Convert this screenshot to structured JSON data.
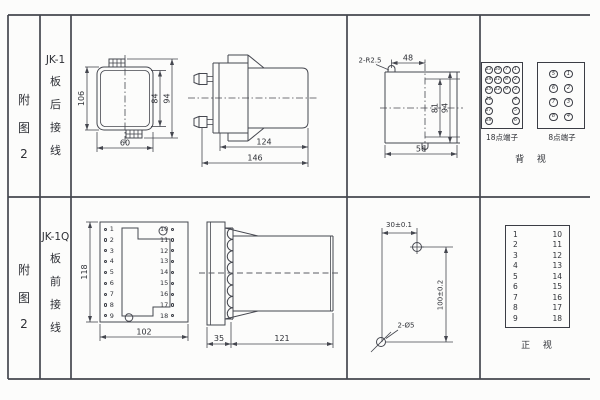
{
  "colors": {
    "line": "#45474f",
    "text": "#2e3036",
    "background": "#fcfcfb"
  },
  "header": {
    "row1": {
      "fig": [
        "附",
        "图",
        "2"
      ],
      "model": "JK-1",
      "wiring": [
        "板",
        "后",
        "接",
        "线"
      ]
    },
    "row2": {
      "fig": [
        "附",
        "图",
        "2"
      ],
      "model": "JK-1Q",
      "wiring": [
        "板",
        "前",
        "接",
        "线"
      ]
    }
  },
  "jk1": {
    "rear": {
      "height": "106",
      "inner": "84",
      "outer": "94",
      "width": "60"
    },
    "side": {
      "body": "124",
      "total": "146"
    },
    "cutout": {
      "radius": "2-R2.5",
      "top": "48",
      "inner": "81",
      "outer": "94",
      "bottom": "56"
    },
    "back_terms": {
      "t18": {
        "label": "18点端子",
        "cells": [
          "13",
          "10",
          "7",
          "1",
          "14",
          "11",
          "8",
          "2",
          "15",
          "12",
          "9",
          "3",
          "16",
          "",
          "",
          "4",
          "17",
          "",
          "",
          "5",
          "18",
          "",
          "",
          "6"
        ]
      },
      "t8": {
        "label": "8点端子",
        "cells": [
          "5",
          "1",
          "6",
          "2",
          "7",
          "3",
          "8",
          "4"
        ]
      },
      "view": "背 视"
    }
  },
  "jk1q": {
    "front": {
      "height": "118",
      "width": "102",
      "left": [
        "1",
        "2",
        "3",
        "4",
        "5",
        "6",
        "7",
        "8",
        "9"
      ],
      "right": [
        "10",
        "11",
        "12",
        "13",
        "14",
        "15",
        "16",
        "17",
        "18"
      ]
    },
    "side": {
      "front": "35",
      "body": "121"
    },
    "drill": {
      "width": "30±0.1",
      "height": "100±0.2",
      "holes": "2-Ø5"
    },
    "front_terms": {
      "left": [
        "1",
        "2",
        "3",
        "4",
        "5",
        "6",
        "7",
        "8",
        "9"
      ],
      "right": [
        "10",
        "11",
        "12",
        "13",
        "14",
        "15",
        "16",
        "17",
        "18"
      ],
      "view": "正 视"
    }
  }
}
